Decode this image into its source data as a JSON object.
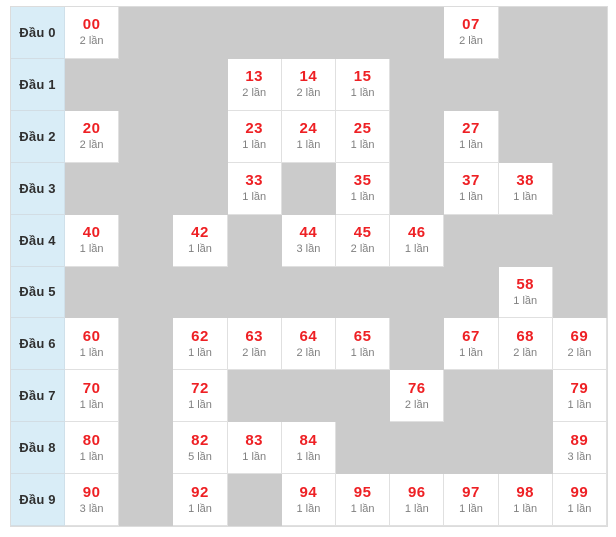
{
  "chart_data": {
    "type": "table",
    "title": "",
    "unit_label": "lần",
    "columns": 10,
    "row_label_prefix": "Đầu",
    "rows": [
      {
        "label": "Đầu 0",
        "cells": [
          {
            "col": 0,
            "number": "00",
            "times": 2,
            "count_label": "2 lần"
          },
          {
            "col": 7,
            "number": "07",
            "times": 2,
            "count_label": "2 lần"
          }
        ]
      },
      {
        "label": "Đầu 1",
        "cells": [
          {
            "col": 3,
            "number": "13",
            "times": 2,
            "count_label": "2 lần"
          },
          {
            "col": 4,
            "number": "14",
            "times": 2,
            "count_label": "2 lần"
          },
          {
            "col": 5,
            "number": "15",
            "times": 1,
            "count_label": "1 lần"
          }
        ]
      },
      {
        "label": "Đầu 2",
        "cells": [
          {
            "col": 0,
            "number": "20",
            "times": 2,
            "count_label": "2 lần"
          },
          {
            "col": 3,
            "number": "23",
            "times": 1,
            "count_label": "1 lần"
          },
          {
            "col": 4,
            "number": "24",
            "times": 1,
            "count_label": "1 lần"
          },
          {
            "col": 5,
            "number": "25",
            "times": 1,
            "count_label": "1 lần"
          },
          {
            "col": 7,
            "number": "27",
            "times": 1,
            "count_label": "1 lần"
          }
        ]
      },
      {
        "label": "Đầu 3",
        "cells": [
          {
            "col": 3,
            "number": "33",
            "times": 1,
            "count_label": "1 lần"
          },
          {
            "col": 5,
            "number": "35",
            "times": 1,
            "count_label": "1 lần"
          },
          {
            "col": 7,
            "number": "37",
            "times": 1,
            "count_label": "1 lần"
          },
          {
            "col": 8,
            "number": "38",
            "times": 1,
            "count_label": "1 lần"
          }
        ]
      },
      {
        "label": "Đầu 4",
        "cells": [
          {
            "col": 0,
            "number": "40",
            "times": 1,
            "count_label": "1 lần"
          },
          {
            "col": 2,
            "number": "42",
            "times": 1,
            "count_label": "1 lần"
          },
          {
            "col": 4,
            "number": "44",
            "times": 3,
            "count_label": "3 lần"
          },
          {
            "col": 5,
            "number": "45",
            "times": 2,
            "count_label": "2 lần"
          },
          {
            "col": 6,
            "number": "46",
            "times": 1,
            "count_label": "1 lần"
          }
        ]
      },
      {
        "label": "Đầu 5",
        "cells": [
          {
            "col": 8,
            "number": "58",
            "times": 1,
            "count_label": "1 lần"
          }
        ]
      },
      {
        "label": "Đầu 6",
        "cells": [
          {
            "col": 0,
            "number": "60",
            "times": 1,
            "count_label": "1 lần"
          },
          {
            "col": 2,
            "number": "62",
            "times": 1,
            "count_label": "1 lần"
          },
          {
            "col": 3,
            "number": "63",
            "times": 2,
            "count_label": "2 lần"
          },
          {
            "col": 4,
            "number": "64",
            "times": 2,
            "count_label": "2 lần"
          },
          {
            "col": 5,
            "number": "65",
            "times": 1,
            "count_label": "1 lần"
          },
          {
            "col": 7,
            "number": "67",
            "times": 1,
            "count_label": "1 lần"
          },
          {
            "col": 8,
            "number": "68",
            "times": 2,
            "count_label": "2 lần"
          },
          {
            "col": 9,
            "number": "69",
            "times": 2,
            "count_label": "2 lần"
          }
        ]
      },
      {
        "label": "Đầu 7",
        "cells": [
          {
            "col": 0,
            "number": "70",
            "times": 1,
            "count_label": "1 lần"
          },
          {
            "col": 2,
            "number": "72",
            "times": 1,
            "count_label": "1 lần"
          },
          {
            "col": 6,
            "number": "76",
            "times": 2,
            "count_label": "2 lần"
          },
          {
            "col": 9,
            "number": "79",
            "times": 1,
            "count_label": "1 lần"
          }
        ]
      },
      {
        "label": "Đầu 8",
        "cells": [
          {
            "col": 0,
            "number": "80",
            "times": 1,
            "count_label": "1 lần"
          },
          {
            "col": 2,
            "number": "82",
            "times": 5,
            "count_label": "5 lần"
          },
          {
            "col": 3,
            "number": "83",
            "times": 1,
            "count_label": "1 lần"
          },
          {
            "col": 4,
            "number": "84",
            "times": 1,
            "count_label": "1 lần"
          },
          {
            "col": 9,
            "number": "89",
            "times": 3,
            "count_label": "3 lần"
          }
        ]
      },
      {
        "label": "Đầu 9",
        "cells": [
          {
            "col": 0,
            "number": "90",
            "times": 3,
            "count_label": "3 lần"
          },
          {
            "col": 2,
            "number": "92",
            "times": 1,
            "count_label": "1 lần"
          },
          {
            "col": 4,
            "number": "94",
            "times": 1,
            "count_label": "1 lần"
          },
          {
            "col": 5,
            "number": "95",
            "times": 1,
            "count_label": "1 lần"
          },
          {
            "col": 6,
            "number": "96",
            "times": 1,
            "count_label": "1 lần"
          },
          {
            "col": 7,
            "number": "97",
            "times": 1,
            "count_label": "1 lần"
          },
          {
            "col": 8,
            "number": "98",
            "times": 1,
            "count_label": "1 lần"
          },
          {
            "col": 9,
            "number": "99",
            "times": 1,
            "count_label": "1 lần"
          }
        ]
      }
    ],
    "colors": {
      "label_bg": "#d9edf7",
      "label_text": "#2f2f2f",
      "filled_bg": "#ffffff",
      "empty_bg": "#cbcbcb",
      "number_text": "#ee2024",
      "count_text": "#808080",
      "grid_line": "#e0e0e0"
    }
  }
}
